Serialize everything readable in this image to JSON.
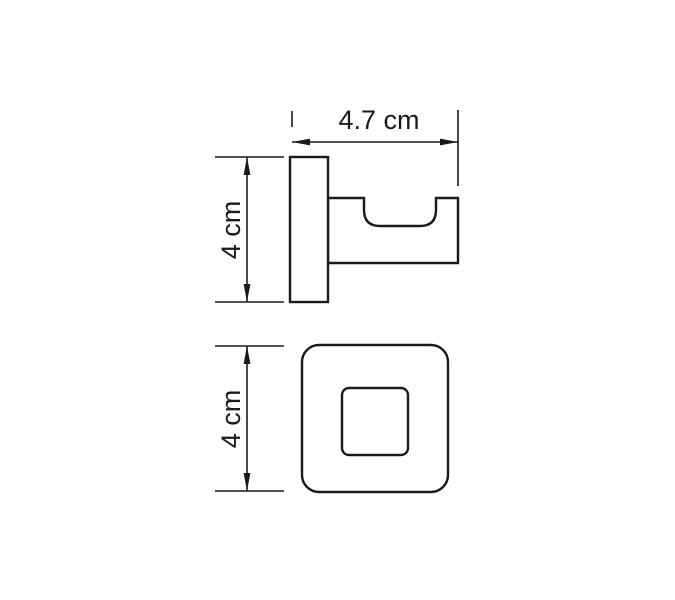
{
  "colors": {
    "line": "#1a1a1a",
    "background": "#ffffff"
  },
  "views": {
    "side": {
      "depth_dimension_label": "4.7 cm",
      "height_dimension_label": "4 cm"
    },
    "front": {
      "height_dimension_label": "4 cm"
    }
  }
}
